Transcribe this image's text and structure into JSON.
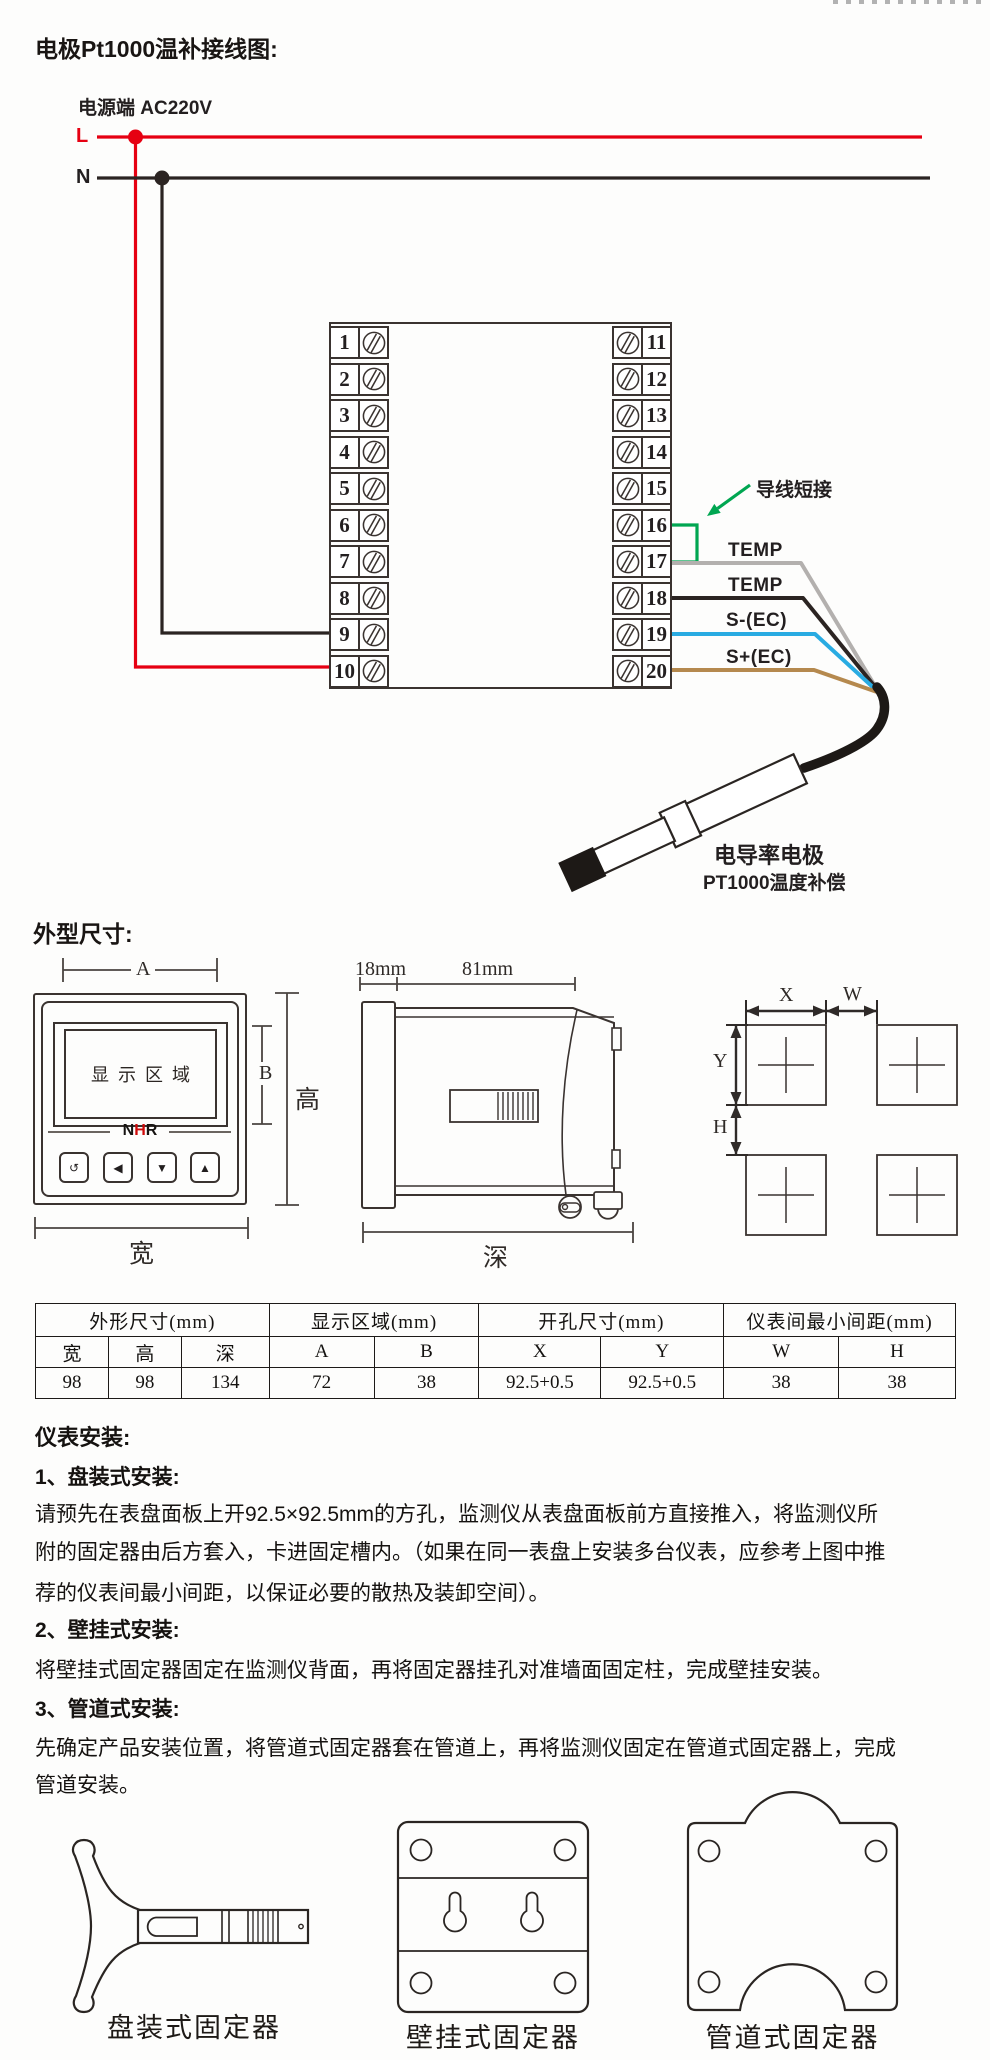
{
  "page": {
    "bg": "#fdfdfc"
  },
  "wiring": {
    "title": "电极Pt1000温补接线图:",
    "power_label": "电源端 AC220V",
    "live_label": "L",
    "neutral_label": "N",
    "jumper_label": "导线短接",
    "wires": [
      {
        "label": "TEMP"
      },
      {
        "label": "TEMP"
      },
      {
        "label": "S-(EC)"
      },
      {
        "label": "S+(EC)"
      }
    ],
    "probe_title": "电导率电极",
    "probe_subtitle": "PT1000温度补偿",
    "terminals_left": [
      "1",
      "2",
      "3",
      "4",
      "5",
      "6",
      "7",
      "8",
      "9",
      "10"
    ],
    "terminals_right": [
      "11",
      "12",
      "13",
      "14",
      "15",
      "16",
      "17",
      "18",
      "19",
      "20"
    ],
    "colors": {
      "live": "#e60012",
      "neutral": "#2b2422",
      "jumper_green": "#00a651",
      "wire_gray": "#b3b0ae",
      "wire_black": "#2b2422",
      "wire_blue": "#29abe2",
      "wire_tan": "#b5894e"
    }
  },
  "outline": {
    "heading": "外型尺寸:",
    "front": {
      "display_area": "显示区域",
      "logo": "NHR",
      "buttons": [
        "↺",
        "◀",
        "▼",
        "▲"
      ],
      "dim_a": "A",
      "dim_b": "B",
      "dim_height": "高",
      "dim_width": "宽"
    },
    "side": {
      "dim_front": "18mm",
      "dim_body": "81mm",
      "dim_depth": "深"
    },
    "cutout": {
      "dim_x": "X",
      "dim_w": "W",
      "dim_y": "Y",
      "dim_h": "H"
    }
  },
  "spec_table": {
    "groups": [
      {
        "label": "外形尺寸(mm)"
      },
      {
        "label": "显示区域(mm)"
      },
      {
        "label": "开孔尺寸(mm)"
      },
      {
        "label": "仪表间最小间距(mm)"
      }
    ],
    "columns": [
      "宽",
      "高",
      "深",
      "A",
      "B",
      "X",
      "Y",
      "W",
      "H"
    ],
    "values": [
      "98",
      "98",
      "134",
      "72",
      "38",
      "92.5+0.5",
      "92.5+0.5",
      "38",
      "38"
    ]
  },
  "install": {
    "heading": "仪表安装:",
    "lines": [
      {
        "text": "1、盘装式安装:"
      },
      {
        "text": "请预先在表盘面板上开92.5×92.5mm的方孔，监测仪从表盘面板前方直接推入，将监测仪所"
      },
      {
        "text": "附的固定器由后方套入，卡进固定槽内。（如果在同一表盘上安装多台仪表，应参考上图中推"
      },
      {
        "text": "荐的仪表间最小间距，以保证必要的散热及装卸空间）。"
      },
      {
        "text": "2、壁挂式安装:"
      },
      {
        "text": "将壁挂式固定器固定在监测仪背面，再将固定器挂孔对准墙面固定柱，完成壁挂安装。"
      },
      {
        "text": "3、管道式安装:"
      },
      {
        "text": "先确定产品安装位置，将管道式固定器套在管道上，再将监测仪固定在管道式固定器上，完成"
      },
      {
        "text": "管道安装。"
      }
    ]
  },
  "fixtures": {
    "labels": [
      "盘装式固定器",
      "壁挂式固定器",
      "管道式固定器"
    ]
  }
}
